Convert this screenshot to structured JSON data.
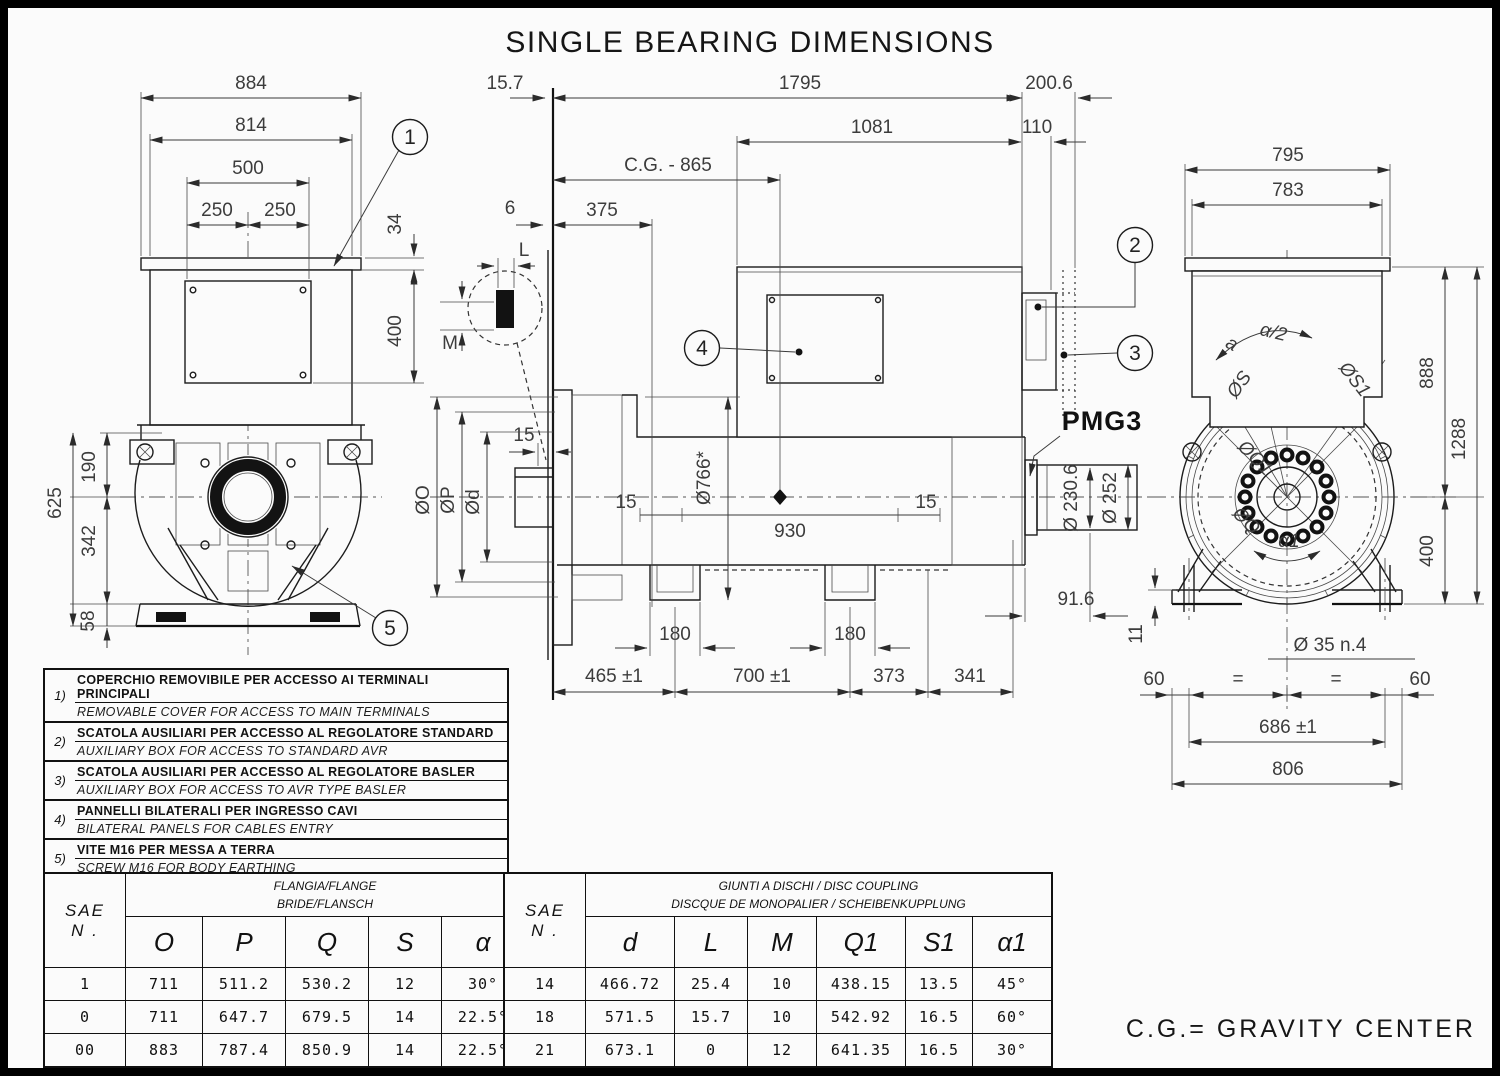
{
  "title": "SINGLE BEARING DIMENSIONS",
  "footer": {
    "cg_note": "C.G.= GRAVITY CENTER"
  },
  "balloons": {
    "n1": "1",
    "n2": "2",
    "n3": "3",
    "n4": "4",
    "n5": "5"
  },
  "front_view": {
    "dims": {
      "w884": "884",
      "w814": "814",
      "w500": "500",
      "w250l": "250",
      "w250r": "250",
      "h34": "34",
      "h400": "400",
      "h625": "625",
      "h190": "190",
      "h342": "342",
      "h58": "58"
    }
  },
  "side_view": {
    "dims": {
      "off157": "15.7",
      "len1795": "1795",
      "len2006": "200.6",
      "len1081": "1081",
      "len110": "110",
      "cg": "C.G. - 865",
      "gap6": "6",
      "shaft375": "375",
      "keyL": "L",
      "keyM": "M",
      "step15": "15",
      "diaO": "ØO",
      "diaP": "ØP",
      "diaD": "Ød",
      "dia766": "Ø766*",
      "core15l": "15",
      "core930": "930",
      "core15r": "15",
      "slot180l": "180",
      "slot180r": "180",
      "b465": "465 ±1",
      "b700": "700 ±1",
      "b373": "373",
      "b341": "341",
      "pmg916": "91.6",
      "dia2306": "Ø 230.6",
      "dia252": "Ø 252",
      "pmg": "PMG3"
    }
  },
  "rear_view": {
    "dims": {
      "w795": "795",
      "w783": "783",
      "a": "a",
      "ahalf": "α/2",
      "diaS": "ØS",
      "diaS1": "ØS1",
      "h888": "888",
      "h1288": "1288",
      "diaQ1": "ØQ1",
      "diaQ": "ØQ",
      "a1": "α1",
      "h400": "400",
      "h11": "11",
      "holes": "Ø 35 n.4",
      "e60l": "60",
      "eql": "=",
      "eqr": "=",
      "e60r": "60",
      "span686": "686 ±1",
      "w806": "806"
    }
  },
  "notes": {
    "items": [
      {
        "num": "1)",
        "it": "COPERCHIO REMOVIBILE PER ACCESSO AI TERMINALI PRINCIPALI",
        "en": "REMOVABLE COVER  FOR ACCESS TO MAIN TERMINALS"
      },
      {
        "num": "2)",
        "it": "SCATOLA AUSILIARI PER ACCESSO AL REGOLATORE STANDARD",
        "en": "AUXILIARY BOX FOR ACCESS TO STANDARD AVR"
      },
      {
        "num": "3)",
        "it": "SCATOLA AUSILIARI PER ACCESSO AL REGOLATORE BASLER",
        "en": "AUXILIARY BOX FOR ACCESS TO AVR TYPE BASLER"
      },
      {
        "num": "4)",
        "it": "PANNELLI BILATERALI PER INGRESSO CAVI",
        "en": "BILATERAL PANELS FOR CABLES ENTRY"
      },
      {
        "num": "5)",
        "it": "VITE M16 PER MESSA A TERRA",
        "en": "SCREW M16 FOR BODY EARTHING"
      }
    ]
  },
  "flange_table": {
    "sae_label": "SAE",
    "n_label": "N .",
    "title_line1": "FLANGIA/FLANGE",
    "title_line2": "BRIDE/FLANSCH",
    "columns": [
      "O",
      "P",
      "Q",
      "S",
      "α"
    ],
    "rows": [
      [
        "1",
        "711",
        "511.2",
        "530.2",
        "12",
        "30°"
      ],
      [
        "0",
        "711",
        "647.7",
        "679.5",
        "14",
        "22.5°"
      ],
      [
        "00",
        "883",
        "787.4",
        "850.9",
        "14",
        "22.5°"
      ]
    ]
  },
  "coupling_table": {
    "sae_label": "SAE",
    "n_label": "N .",
    "title_line1": "GIUNTI A DISCHI / DISC COUPLING",
    "title_line2": "DISCQUE DE MONOPALIER / SCHEIBENKUPPLUNG",
    "columns": [
      "d",
      "L",
      "M",
      "Q1",
      "S1",
      "α1"
    ],
    "rows": [
      [
        "14",
        "466.72",
        "25.4",
        "10",
        "438.15",
        "13.5",
        "45°"
      ],
      [
        "18",
        "571.5",
        "15.7",
        "10",
        "542.92",
        "16.5",
        "60°"
      ],
      [
        "21",
        "673.1",
        "0",
        "12",
        "641.35",
        "16.5",
        "30°"
      ]
    ]
  }
}
